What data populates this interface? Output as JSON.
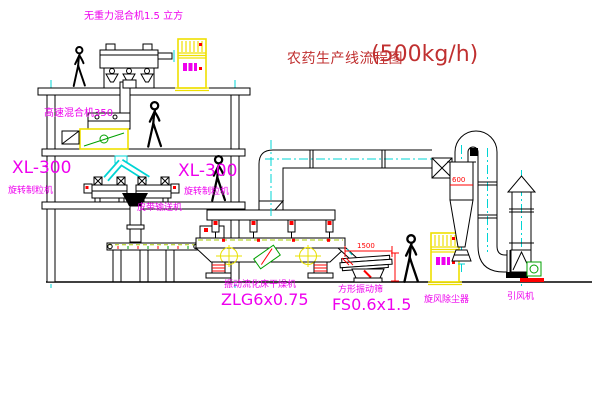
{
  "title": {
    "name": "农药生产线流程图",
    "capacity": "(500kg/h)"
  },
  "labels": {
    "gravity_mixer": "无重力混合机1.5 立方",
    "high_speed_mixer": "高速混合机350",
    "granulator_left_model": "XL-300",
    "granulator_left_name": "旋转制粒机",
    "granulator_right_model": "XL-300",
    "granulator_right_name": "旋转制粒机",
    "belt_conveyor": "皮带输送机",
    "dryer_name": "振动流化床干燥机",
    "dryer_model": "ZLG6x0.75",
    "screen_name": "方形振动筛",
    "screen_model": "FS0.6x1.5",
    "cyclone_name": "旋风除尘器",
    "fan_name": "引风机"
  },
  "dimensions": {
    "screen_length": "1500",
    "cyclone_width": "600"
  },
  "colors": {
    "line": "#000000",
    "centerline": "#00D4D4",
    "label_magenta": "#EE00EE",
    "title_red": "#C03030",
    "dimension_red": "#FF0000",
    "cabinet_yellow": "#EFE000",
    "accent_green": "#00A000"
  }
}
